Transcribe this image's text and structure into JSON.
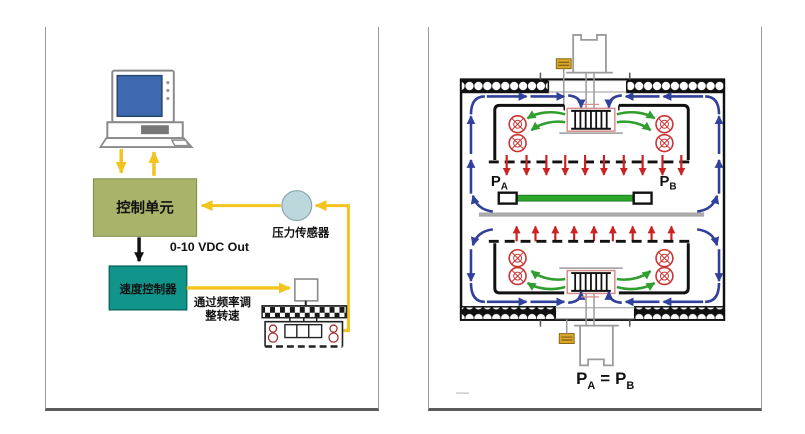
{
  "colors": {
    "accent_yellow": "#f2c41d",
    "control_unit_bg": "#a9b46a",
    "speed_controller_bg": "#11948a",
    "pressure_sensor_bg": "#bdd8dc",
    "flow_blue": "#31409b",
    "flow_green": "#2f9e2f",
    "flow_red": "#cc2222",
    "product_green": "#2aa52a",
    "capacitor_gold": "#d9a62a",
    "monitor_screen_blue": "#3f69ae"
  },
  "left_panel": {
    "control_unit_label": "控制单元",
    "pressure_sensor_label": "压力传感器",
    "vdc_out_label": "0-10 VDC Out",
    "speed_controller_label": "速度控制器",
    "frequency_note_line1": "通过频率调",
    "frequency_note_line2": "整转速"
  },
  "right_panel": {
    "pressure_a_base": "P",
    "pressure_a_sub": "A",
    "pressure_b_base": "P",
    "pressure_b_sub": "B",
    "equation": {
      "left_base": "P",
      "left_sub": "A",
      "equals": "=",
      "right_base": "P",
      "right_sub": "B"
    }
  }
}
